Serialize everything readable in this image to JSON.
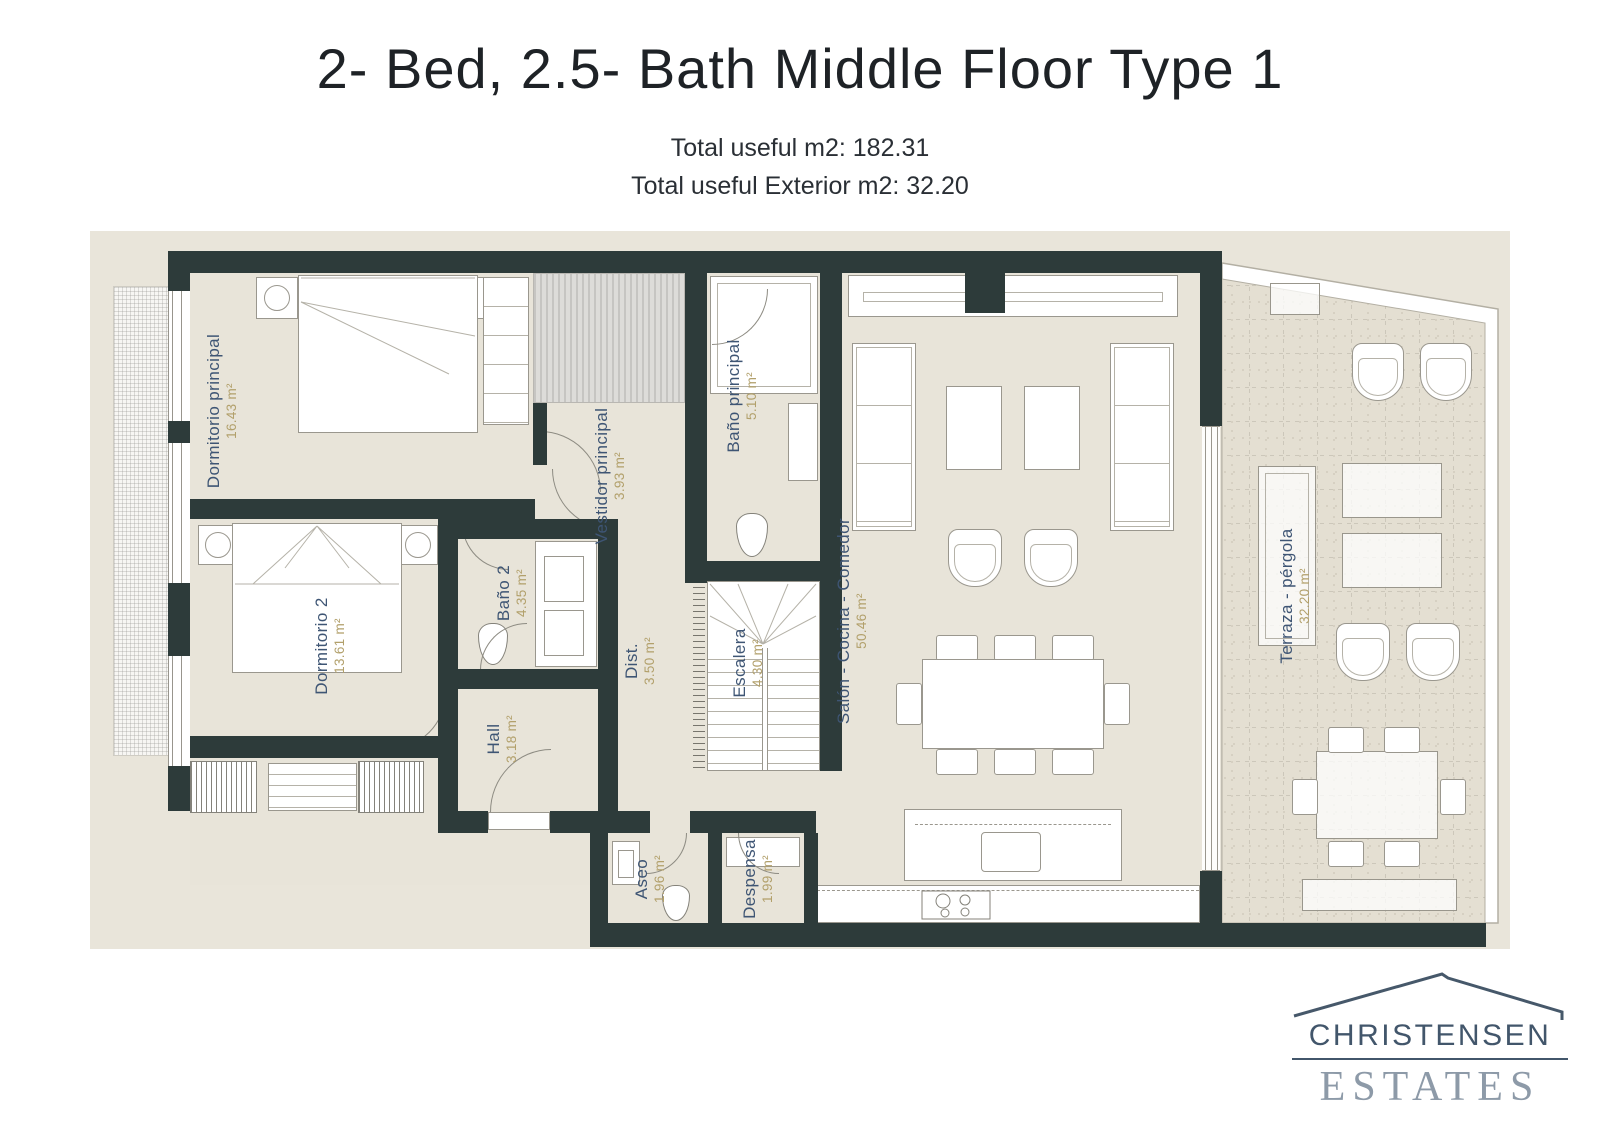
{
  "page": {
    "title": "2- Bed, 2.5- Bath Middle Floor Type 1",
    "total_useful": "Total useful m2: 182.31",
    "total_exterior": "Total useful Exterior m2: 32.20"
  },
  "plan": {
    "rooms": [
      {
        "name": "Dormitorio principal",
        "area": "16.43 m²"
      },
      {
        "name": "Dormitorio 2",
        "area": "13.61 m²"
      },
      {
        "name": "Baño 2",
        "area": "4.35 m²"
      },
      {
        "name": "Hall",
        "area": "3.18 m²"
      },
      {
        "name": "Dist.",
        "area": "3.50 m²"
      },
      {
        "name": "Vestidor principal",
        "area": "3.93 m²"
      },
      {
        "name": "Baño principal",
        "area": "5.10 m²"
      },
      {
        "name": "Escalera",
        "area": "4.30 m²"
      },
      {
        "name": "Salón - Cocina - Comedor",
        "area": "50.46 m²"
      },
      {
        "name": "Aseo",
        "area": "1.96 m²"
      },
      {
        "name": "Despensa",
        "area": "1.99 m²"
      },
      {
        "name": "Terraza - pérgola",
        "area": "32.20 m²"
      }
    ]
  },
  "logo": {
    "line1": "CHRISTENSEN",
    "line2": "ESTATES"
  },
  "colors": {
    "wall": "#2d3b3a",
    "floor": "#e8e4d9",
    "plan_background": "#e9e5da",
    "room_name_text": "#3e5574",
    "room_area_text": "#b2a06b",
    "logo_primary": "#42566b",
    "logo_secondary": "#8d9aa8"
  }
}
